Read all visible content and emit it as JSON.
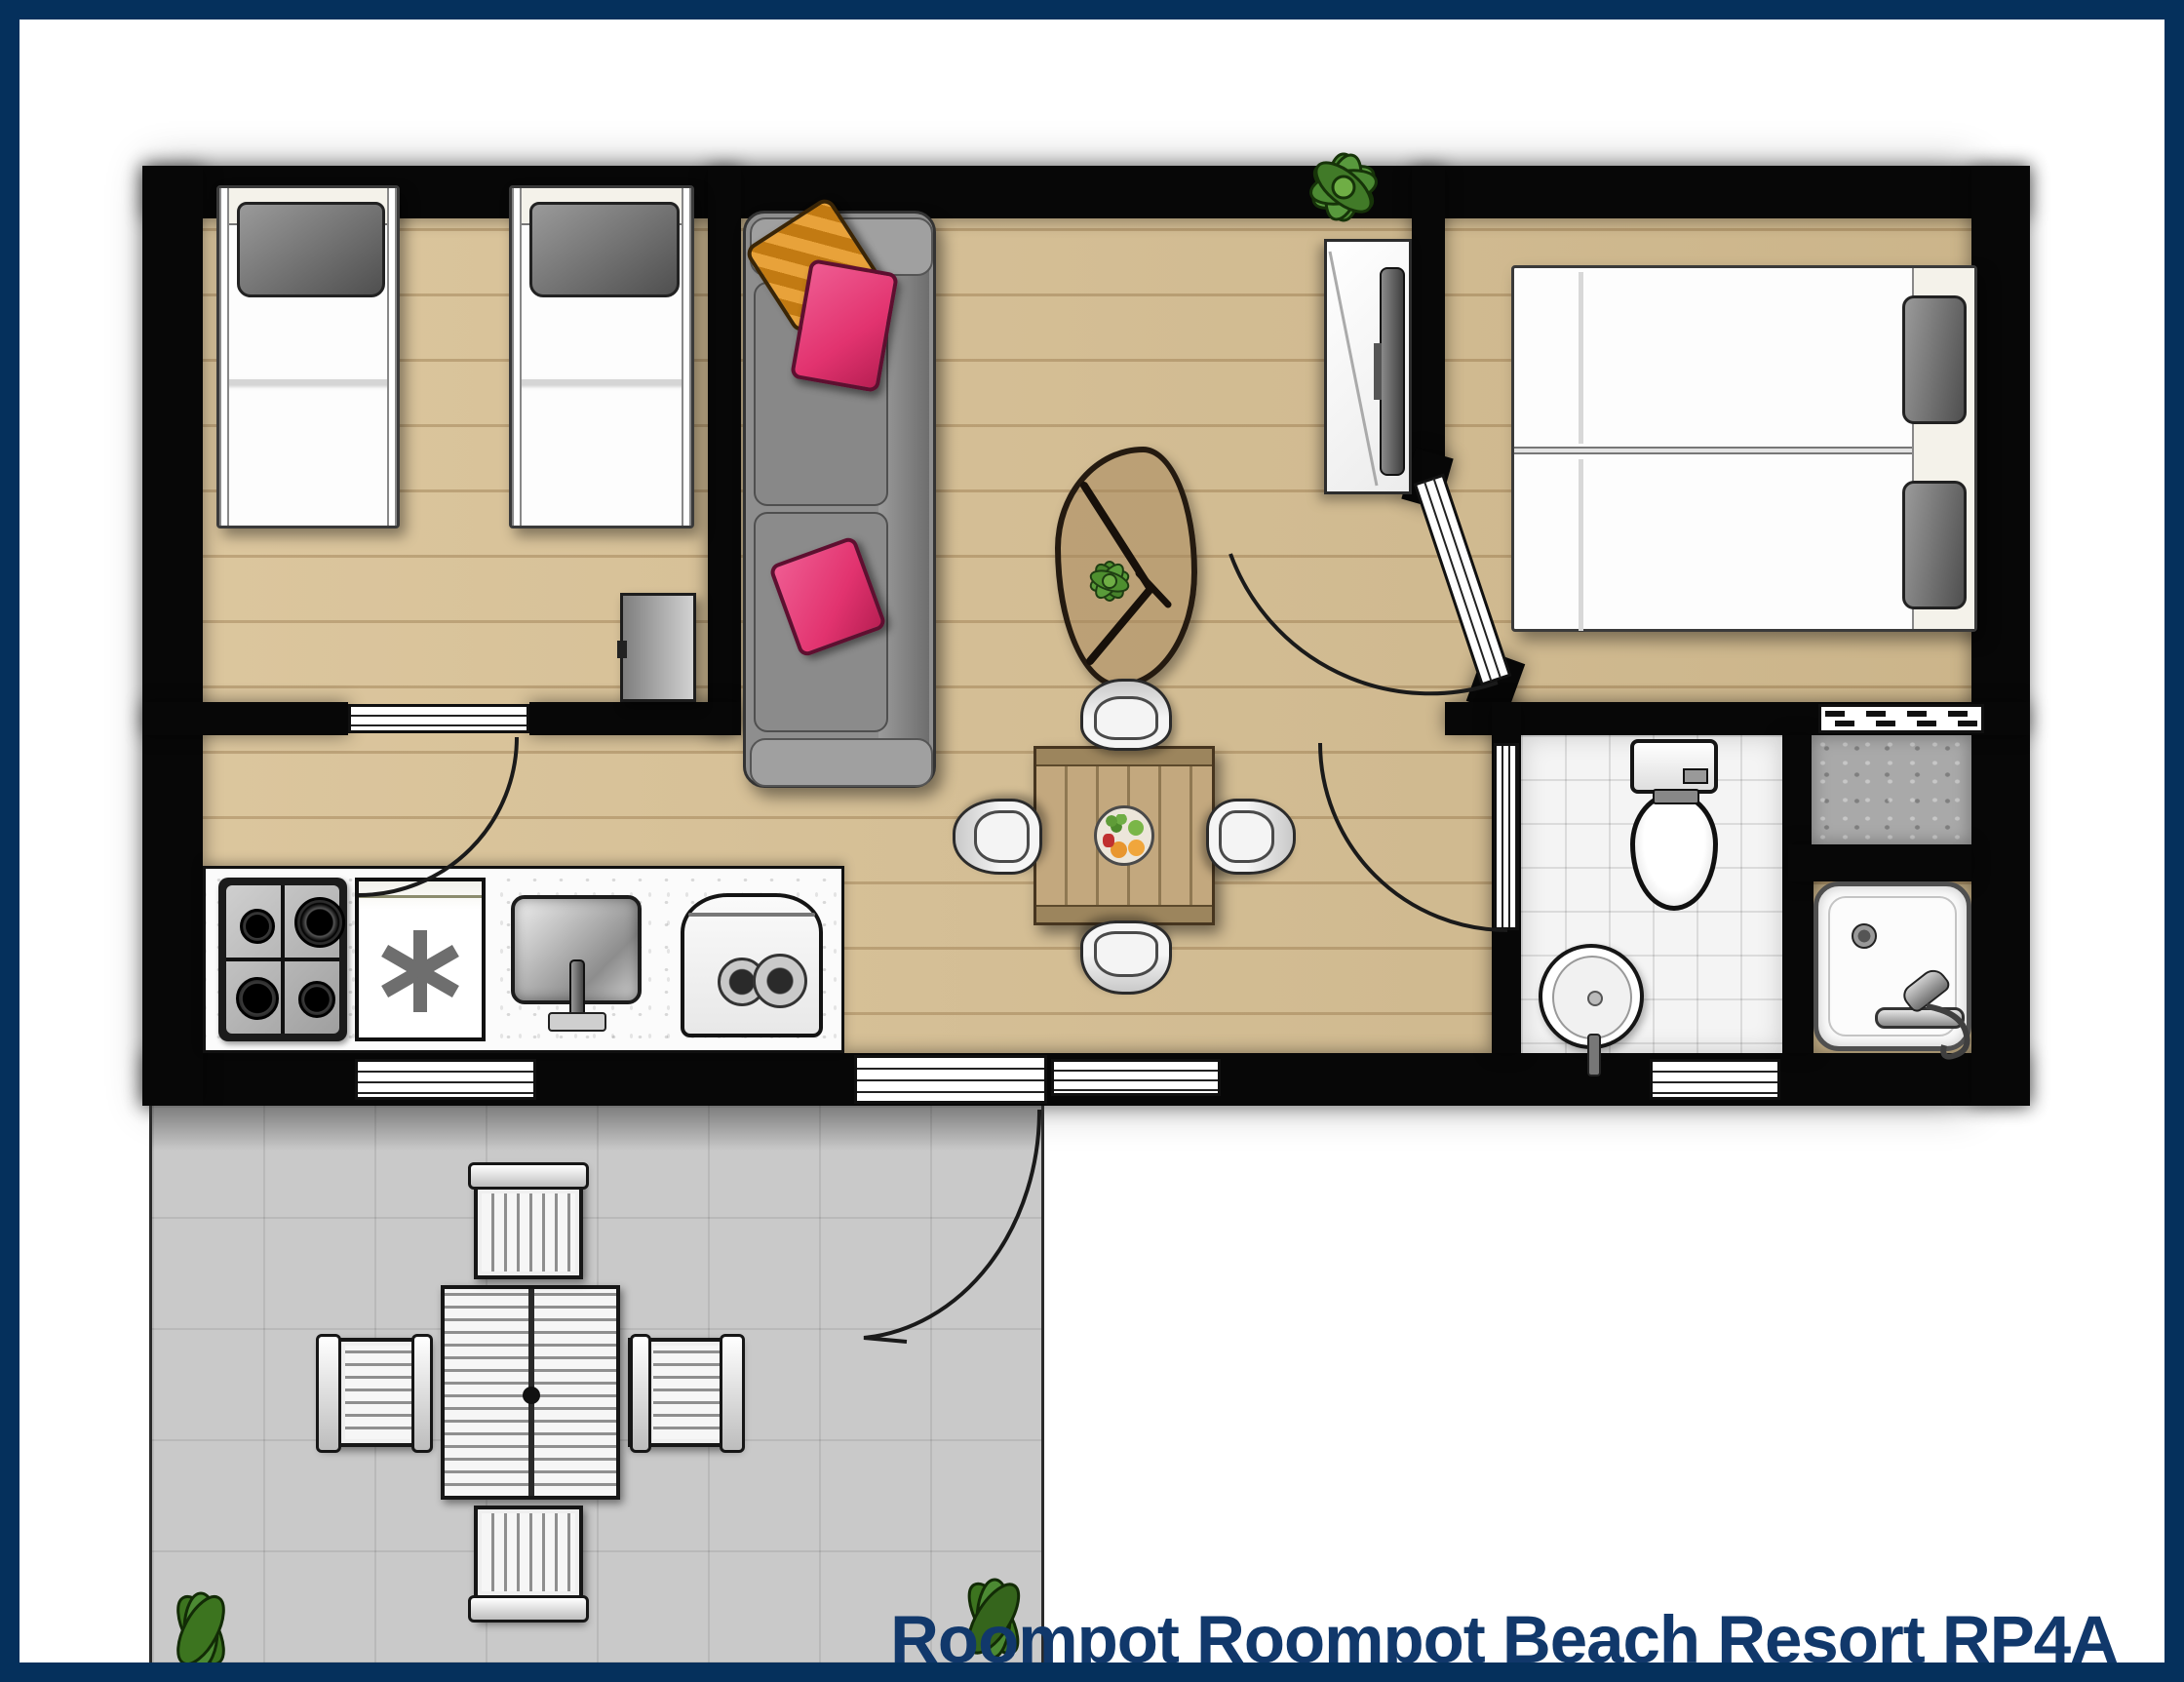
{
  "title": "Roompot Roompot Beach Resort RP4A",
  "colors": {
    "frame_navy": "#05305c",
    "title_navy": "#11386b",
    "wall_black": "#070707",
    "wood_floor": "#d8c093",
    "wood_plank_line": "#b3945f",
    "terrace_gray": "#c9c9c9",
    "tile_white": "#f4f4f4",
    "sofa_gray": "#8e8e8e",
    "pillow_pink": "#e2336f",
    "pillow_orange": "#e8a23a",
    "bed_pillow_gray": "#6f6f6f",
    "table_wood": "#c3a87e",
    "plant_green": "#4c8a33",
    "closet_gray": "#a9a9a9"
  },
  "floorplan": {
    "label": "Holiday home top-view floor plan",
    "rooms": [
      "twin-bedroom",
      "living-room",
      "kitchen",
      "dining-area",
      "double-bedroom",
      "bathroom",
      "storage-closet",
      "terrace"
    ],
    "furniture": {
      "twin_bedroom": [
        "single-bed",
        "single-bed",
        "cabinet"
      ],
      "living_room": [
        "sofa",
        "throw-pillows",
        "coffee-table",
        "tv-cabinet",
        "plant"
      ],
      "kitchen": [
        "gas-hob",
        "freezer",
        "sink",
        "boiler"
      ],
      "dining_area": [
        "dining-table",
        "four-chairs",
        "fruit-bowl"
      ],
      "double_bedroom": [
        "single-bed",
        "single-bed"
      ],
      "bathroom": [
        "toilet",
        "washbasin",
        "shower"
      ],
      "terrace": [
        "garden-table",
        "four-garden-chairs",
        "plants"
      ]
    }
  }
}
